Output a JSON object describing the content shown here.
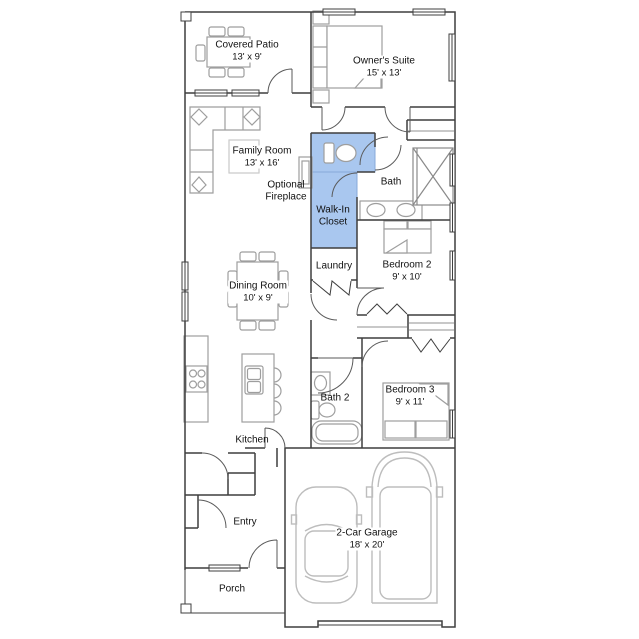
{
  "plan": {
    "type": "single-story floor plan",
    "highlight": {
      "color": "#a9c7ef",
      "selected_room": "Walk-In Closet"
    },
    "rooms": [
      {
        "id": "covered-patio",
        "label": "Covered Patio",
        "dims": "13' x 9'"
      },
      {
        "id": "owners-suite",
        "label": "Owner's Suite",
        "dims": "15' x 13'"
      },
      {
        "id": "family-room",
        "label": "Family Room",
        "dims": "13' x 16'"
      },
      {
        "id": "bath",
        "label": "Bath",
        "dims": ""
      },
      {
        "id": "walk-in-closet",
        "label": "Walk-In Closet",
        "dims": "",
        "highlighted": true
      },
      {
        "id": "laundry",
        "label": "Laundry",
        "dims": ""
      },
      {
        "id": "bedroom-2",
        "label": "Bedroom 2",
        "dims": "9' x 10'"
      },
      {
        "id": "dining-room",
        "label": "Dining Room",
        "dims": "10' x 9'"
      },
      {
        "id": "bath-2",
        "label": "Bath 2",
        "dims": ""
      },
      {
        "id": "bedroom-3",
        "label": "Bedroom 3",
        "dims": "9' x 11'"
      },
      {
        "id": "kitchen",
        "label": "Kitchen",
        "dims": ""
      },
      {
        "id": "entry",
        "label": "Entry",
        "dims": ""
      },
      {
        "id": "garage",
        "label": "2-Car Garage",
        "dims": "18' x 20'"
      },
      {
        "id": "porch",
        "label": "Porch",
        "dims": ""
      }
    ],
    "annotations": [
      {
        "id": "optional-fireplace",
        "label": "Optional Fireplace"
      }
    ],
    "colors": {
      "walls": "#3f3f3f",
      "furniture": "#9e9e9e",
      "vehicles": "#bdbdbd",
      "highlight_fill": "#a9c7ef",
      "highlight_stroke": "#87a8d8"
    }
  }
}
